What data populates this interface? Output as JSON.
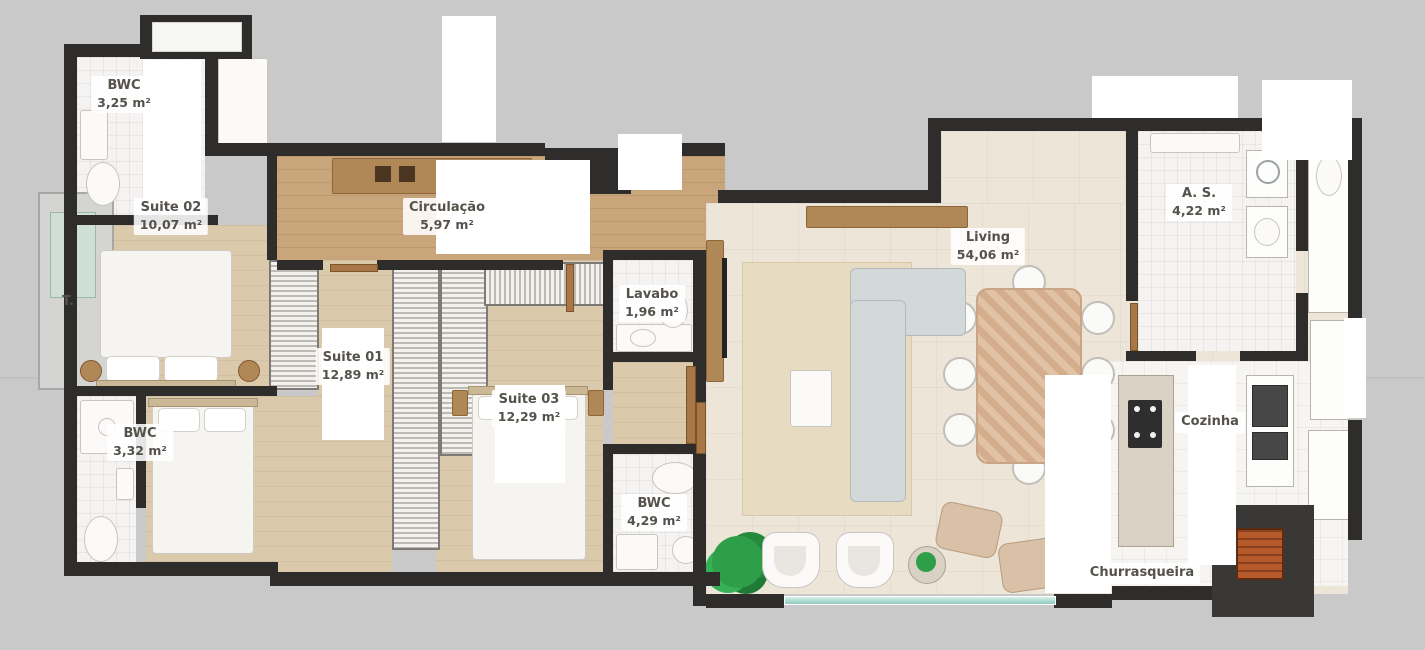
{
  "plan": {
    "type": "apartment-floor-plan",
    "colors": {
      "background": "#c9c9c9",
      "walls": "#2f2d2b",
      "corridor_wood_floor": "#c8a57a",
      "suite_floor": "#dbc9ab",
      "living_floor": "#ece5d8",
      "glass_railing": "#8fcabb",
      "grill_brick": "#b65a2c",
      "plant_green": "#2f9e49"
    },
    "rooms": {
      "bwc_top": {
        "name": "BWC",
        "area": "3,25 m²"
      },
      "suite02": {
        "name": "Suite 02",
        "area": "10,07 m²"
      },
      "circulacao": {
        "name": "Circulação",
        "area": "5,97 m²"
      },
      "elevator": {
        "name": "T."
      },
      "suite01": {
        "name": "Suite 01",
        "area": "12,89 m²"
      },
      "suite03": {
        "name": "Suite 03",
        "area": "12,29 m²"
      },
      "lavabo": {
        "name": "Lavabo",
        "area": "1,96 m²"
      },
      "bwc_left": {
        "name": "BWC",
        "area": "3,32 m²"
      },
      "bwc_middle": {
        "name": "BWC",
        "area": "4,29 m²"
      },
      "living": {
        "name": "Living",
        "area": "54,06 m²"
      },
      "area_servico": {
        "name": "A. S.",
        "area": "4,22 m²"
      },
      "cozinha": {
        "name": "Cozinha"
      },
      "churrasqueira": {
        "name": "Churrasqueira"
      }
    }
  }
}
